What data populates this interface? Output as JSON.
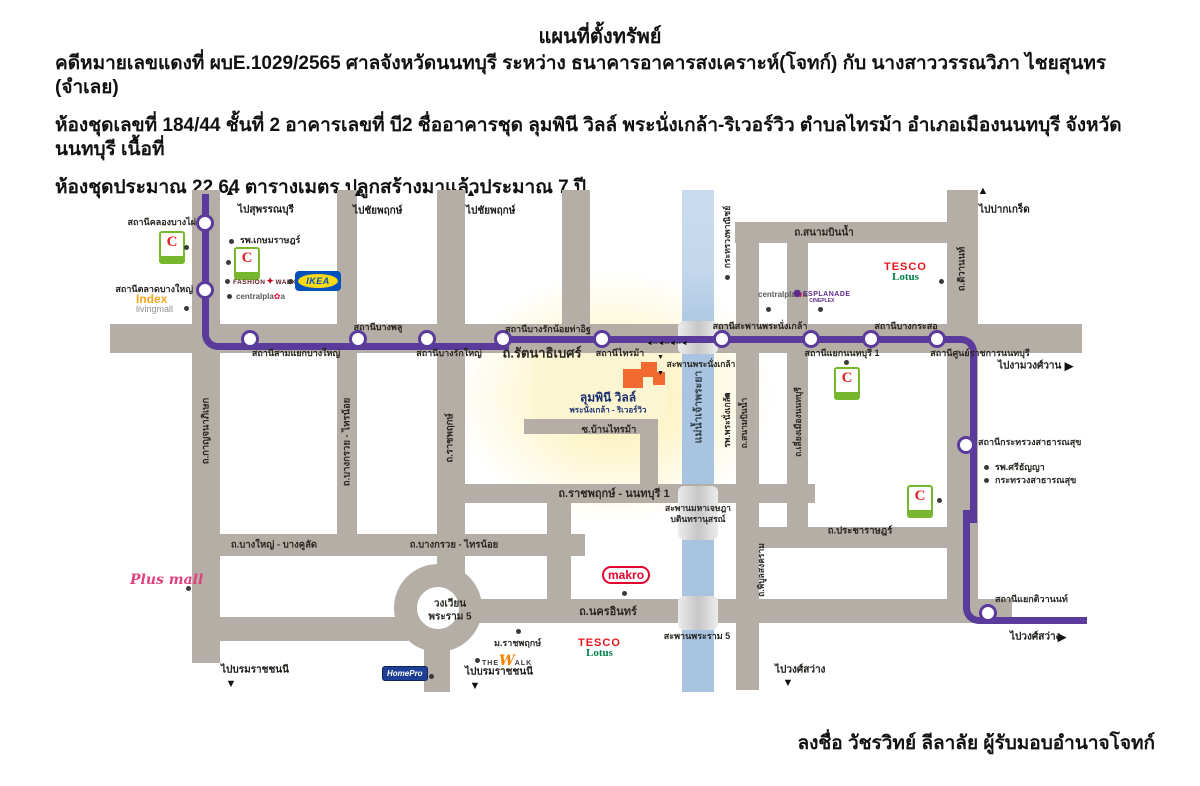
{
  "doc": {
    "title": "แผนที่ตั้งทรัพย์",
    "lines": [
      "คดีหมายเลขแดงที่ ผบE.1029/2565 ศาลจังหวัดนนทบุรี  ระหว่าง ธนาคารอาคารสงเคราะห์(โจทก์) กับ นางสาววรรณวิภา ไชยสุนทร (จำเลย)",
      "ห้องชุดเลขที่ 184/44 ชั้นที่ 2 อาคารเลขที่ บี2 ชื่ออาคารชุด ลุมพินี วิลล์ พระนั่งเกล้า-ริเวอร์วิว ตำบลไทรม้า อำเภอเมืองนนทบุรี จังหวัดนนทบุรี เนื้อที่",
      "ห้องชุดประมาณ 22.64 ตารางเมตร ปลูกสร้างมาแล้วประมาณ 7 ปี"
    ],
    "signature": "ลงชื่อ วัชรวิทย์ ลีลาลัย ผู้รับมอบอำนาจโจทก์"
  },
  "map": {
    "colors": {
      "road": "#b5aea6",
      "metro_line": "#5a3b9b",
      "river": "#a8c4e0",
      "highlight": "#fbeea5"
    },
    "walk_arrows": {
      "left_row": "◄--◄--◄--◄",
      "down": "▼"
    },
    "stations": [
      {
        "name": "สถานีคลองบางไผ่",
        "cx": 205,
        "cy": 223,
        "lx": 196,
        "ly": 222,
        "align": "right"
      },
      {
        "name": "สถานีตลาดบางใหญ่",
        "cx": 205,
        "cy": 290,
        "lx": 193,
        "ly": 289,
        "align": "right"
      },
      {
        "name": "สถานีสามแยกบางใหญ่",
        "cx": 250,
        "cy": 339,
        "lx": 296,
        "ly": 353,
        "align": "center"
      },
      {
        "name": "สถานีบางพลู",
        "cx": 358,
        "cy": 339,
        "lx": 378,
        "ly": 327,
        "align": "center"
      },
      {
        "name": "สถานีบางรักใหญ่",
        "cx": 427,
        "cy": 339,
        "lx": 449,
        "ly": 353,
        "align": "center"
      },
      {
        "name": "สถานีบางรักน้อยท่าอิฐ",
        "cx": 503,
        "cy": 339,
        "lx": 548,
        "ly": 329,
        "align": "center"
      },
      {
        "name": "สถานีไทรม้า",
        "cx": 602,
        "cy": 339,
        "lx": 620,
        "ly": 353,
        "align": "center"
      },
      {
        "name": "สถานีสะพานพระนั่งเกล้า",
        "cx": 722,
        "cy": 339,
        "lx": 760,
        "ly": 326,
        "align": "center"
      },
      {
        "name": "สถานีแยกนนทบุรี 1",
        "cx": 811,
        "cy": 339,
        "lx": 842,
        "ly": 353,
        "align": "center"
      },
      {
        "name": "สถานีบางกระสอ",
        "cx": 871,
        "cy": 339,
        "lx": 906,
        "ly": 326,
        "align": "center"
      },
      {
        "name": "สถานีศูนย์ราชการนนทบุรี",
        "cx": 937,
        "cy": 339,
        "lx": 980,
        "ly": 353,
        "align": "center"
      },
      {
        "name": "สถานีกระทรวงสาธารณสุข",
        "cx": 966,
        "cy": 445,
        "lx": 978,
        "ly": 442,
        "align": "left"
      },
      {
        "name": "สถานีแยกติวานนท์",
        "cx": 988,
        "cy": 613,
        "lx": 995,
        "ly": 599,
        "align": "left"
      }
    ],
    "road_labels": [
      {
        "text": "ถ.รัตนาธิเบศร์",
        "x": 542,
        "y": 353,
        "size": 13
      },
      {
        "text": "ถ.สนามบินน้ำ",
        "x": 824,
        "y": 233,
        "size": 10
      },
      {
        "text": "ถ.บางใหญ่ - บางคูลัด",
        "x": 274,
        "y": 545,
        "size": 9.5
      },
      {
        "text": "ถ.บางกรวย - ไทรน้อย",
        "x": 454,
        "y": 545,
        "size": 9.5
      },
      {
        "text": "ถ.ราชพฤกษ์ - นนทบุรี 1",
        "x": 614,
        "y": 493,
        "size": 11
      },
      {
        "text": "ถ.นครอินทร์",
        "x": 608,
        "y": 611,
        "size": 11
      },
      {
        "text": "ถ.ประชาราษฎร์",
        "x": 860,
        "y": 531,
        "size": 9.5
      },
      {
        "text": "ซ.บ้านไทรม้า",
        "x": 609,
        "y": 430,
        "size": 9.5
      },
      {
        "text": "ถ.กาญจนาภิเษก",
        "x": 206,
        "y": 431,
        "size": 9.5,
        "vertical": true
      },
      {
        "text": "ถ.บางกรวย - ไทรน้อย",
        "x": 347,
        "y": 442,
        "size": 9.5,
        "vertical": true
      },
      {
        "text": "ถ.ราชพฤกษ์",
        "x": 450,
        "y": 438,
        "size": 9.5,
        "vertical": true
      },
      {
        "text": "ถ.ติวานนท์",
        "x": 962,
        "y": 269,
        "size": 9.5,
        "vertical": true
      },
      {
        "text": "ถ.สนามบินน้ำ",
        "x": 744,
        "y": 423,
        "size": 8.5,
        "vertical": true
      },
      {
        "text": "ถ.เลี่ยงเมืองนนทบุรี",
        "x": 798,
        "y": 422,
        "size": 8.5,
        "vertical": true
      },
      {
        "text": "ถ.พิบูลสงคราม",
        "x": 761,
        "y": 570,
        "size": 8.5,
        "vertical": true
      },
      {
        "text": "แม่น้ำเจ้าพระยา",
        "x": 698,
        "y": 407,
        "size": 10.5,
        "vertical": true,
        "color": "#31404f"
      },
      {
        "text": "รพ.พระนั่งเกล้า",
        "x": 727,
        "y": 420,
        "size": 8.5,
        "vertical": true
      },
      {
        "text": "กระทรวงพาณิชย์",
        "x": 727,
        "y": 237,
        "size": 8.5,
        "vertical": true
      }
    ],
    "destinations": [
      {
        "text": "ไปสุพรรณบุรี",
        "dir": "up",
        "ax": 230,
        "ay": 192,
        "x": 238,
        "y": 210
      },
      {
        "text": "ไปชัยพฤกษ์",
        "dir": "up",
        "ax": 358,
        "ay": 193,
        "x": 353,
        "y": 211
      },
      {
        "text": "ไปชัยพฤกษ์",
        "dir": "up",
        "ax": 471,
        "ay": 193,
        "x": 466,
        "y": 211
      },
      {
        "text": "ไปปากเกร็ด",
        "dir": "up",
        "ax": 983,
        "ay": 191,
        "x": 979,
        "y": 210
      },
      {
        "text": "ไปงามวงศ์วาน",
        "dir": "right",
        "ax": 1069,
        "ay": 366,
        "x": 998,
        "y": 366
      },
      {
        "text": "ไปวงศ์สว่าง",
        "dir": "right",
        "ax": 1062,
        "ay": 637,
        "x": 1010,
        "y": 637
      },
      {
        "text": "ไปวงศ์สว่าง",
        "dir": "down",
        "ax": 788,
        "ay": 683,
        "x": 775,
        "y": 670
      },
      {
        "text": "ไปบรมราชชนนี",
        "dir": "down",
        "ax": 231,
        "ay": 684,
        "x": 221,
        "y": 670
      },
      {
        "text": "ไปบรมราชชนนี",
        "dir": "down",
        "ax": 475,
        "ay": 686,
        "x": 465,
        "y": 672
      }
    ],
    "pois": [
      {
        "text": "รพ.เกษมราษฎร์",
        "dx": 231,
        "dy": 241,
        "x": 240,
        "y": 240
      },
      {
        "text": "รพ.ศรีธัญญา",
        "dx": 986,
        "dy": 467,
        "x": 995,
        "y": 467
      },
      {
        "text": "กระทรวงสาธารณสุข",
        "dx": 986,
        "dy": 480,
        "x": 995,
        "y": 480
      },
      {
        "text": "ม.ราชพฤกษ์",
        "dx": 518,
        "dy": 631,
        "x": 494,
        "y": 643
      },
      {
        "dx": 186,
        "dy": 247
      },
      {
        "dx": 228,
        "dy": 262
      },
      {
        "dx": 186,
        "dy": 308
      },
      {
        "dx": 227,
        "dy": 281
      },
      {
        "dx": 290,
        "dy": 281
      },
      {
        "dx": 229,
        "dy": 296
      },
      {
        "dx": 941,
        "dy": 281
      },
      {
        "dx": 768,
        "dy": 309
      },
      {
        "dx": 820,
        "dy": 309
      },
      {
        "dx": 727,
        "dy": 277
      },
      {
        "dx": 727,
        "dy": 395
      },
      {
        "dx": 846,
        "dy": 362
      },
      {
        "dx": 939,
        "dy": 500
      },
      {
        "dx": 624,
        "dy": 593
      },
      {
        "dx": 477,
        "dy": 660
      },
      {
        "dx": 431,
        "dy": 676
      },
      {
        "dx": 188,
        "dy": 588
      }
    ],
    "texts": [
      {
        "text": "สะพานพระนั่งเกล้า",
        "x": 701,
        "y": 364,
        "size": 8.5
      },
      {
        "text": "สะพานมหาเจษฎา",
        "x": 698,
        "y": 508,
        "size": 8.5
      },
      {
        "text": "บดินทรานุสรณ์",
        "x": 698,
        "y": 519,
        "size": 8.5
      },
      {
        "text": "สะพานพระราม 5",
        "x": 697,
        "y": 636,
        "size": 9
      },
      {
        "text": "วงเวียน",
        "x": 450,
        "y": 604,
        "size": 10
      },
      {
        "text": "พระราม 5",
        "x": 450,
        "y": 617,
        "size": 10
      },
      {
        "text": "ลุมพินี วิลล์",
        "x": 608,
        "y": 398,
        "size": 12,
        "color": "#1a2f6e"
      },
      {
        "text": "พระนั่งเกล้า - ริเวอร์วิว",
        "x": 608,
        "y": 410,
        "size": 8,
        "color": "#1a2f6e"
      }
    ],
    "logos": {
      "bigc_letter": "C",
      "ikea": "IKEA",
      "fashion_1": "FASHION",
      "fashion_2": "WALK",
      "central_1": "centralpla",
      "central_2": "a",
      "esplanade_1": "ESPLANADE",
      "esplanade_2": "CINEPLEX",
      "tesco_top": "TESCO",
      "tesco_bottom": "Lotus",
      "makro": "makro",
      "index_top": "Index",
      "index_bottom": "livingmall",
      "plusmall": "Plus mall",
      "thewalk_1": "THE",
      "thewalk_w": "W",
      "thewalk_2": "ALK",
      "homepro": "HomePro"
    }
  }
}
